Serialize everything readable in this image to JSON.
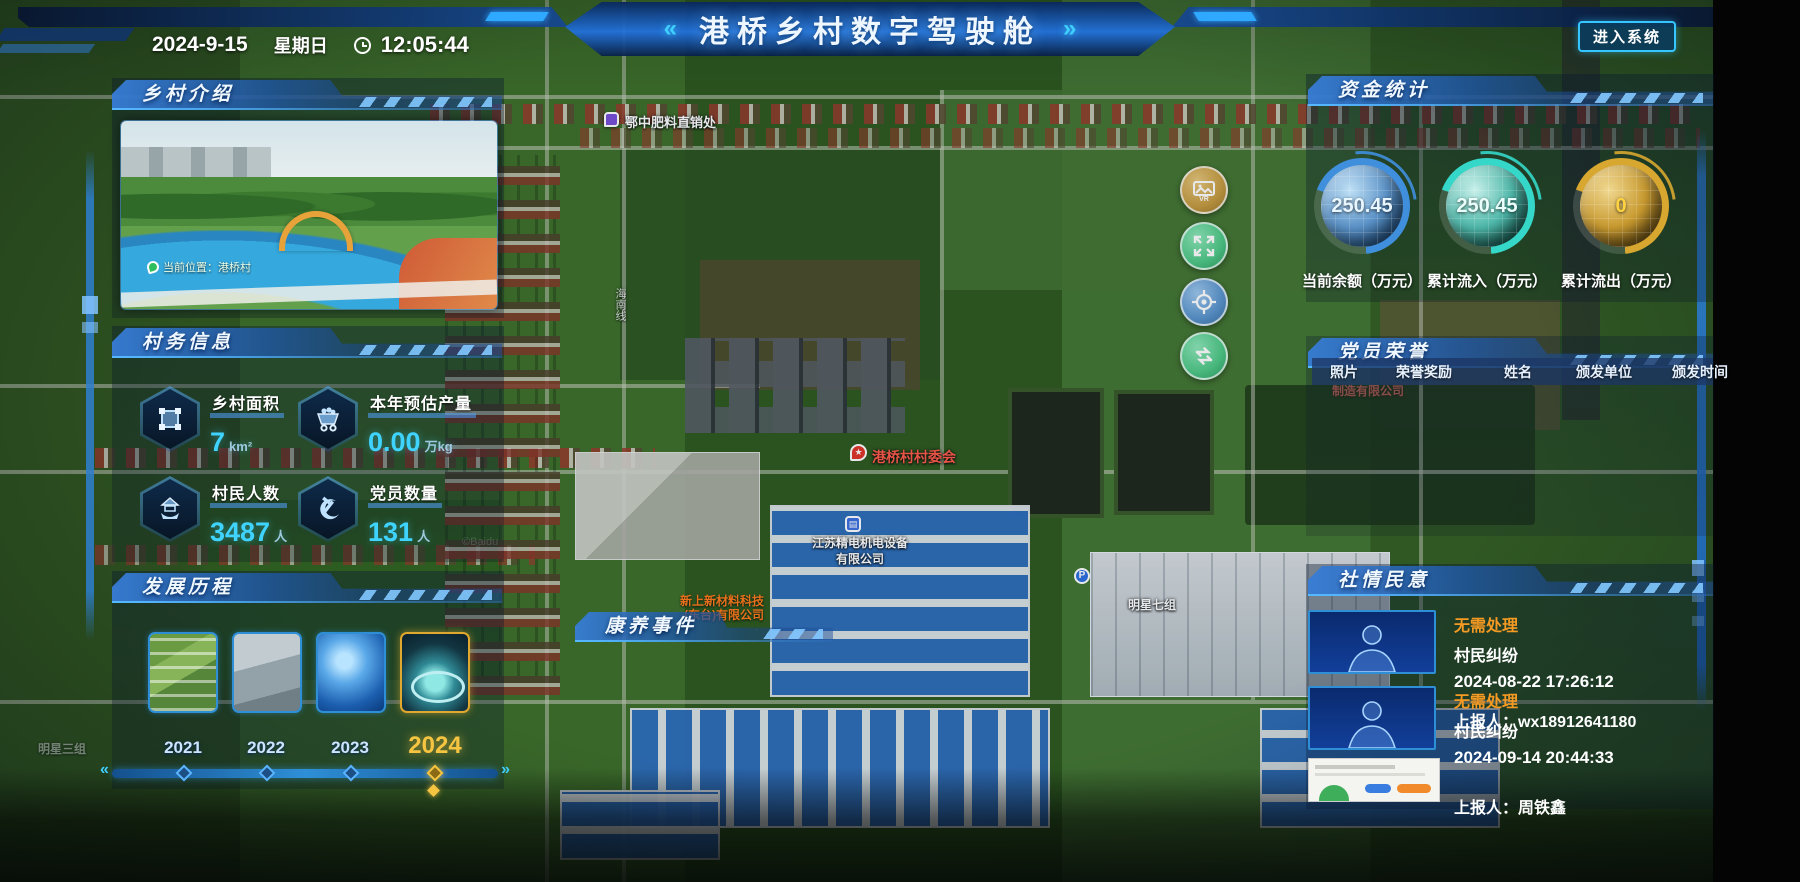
{
  "header": {
    "date": "2024-9-15",
    "weekday": "星期日",
    "time": "12:05:44",
    "title": "港桥乡村数字驾驶舱",
    "chevrons_left": "«",
    "chevrons_right": "»",
    "enter_button": "进入系统"
  },
  "panels": {
    "intro": {
      "title": "乡村介绍",
      "photo_badge": "当前位置：港桥村"
    },
    "info": {
      "title": "村务信息",
      "stats": [
        {
          "label": "乡村面积",
          "value": "7",
          "unit": "km²"
        },
        {
          "label": "本年预估产量",
          "value": "0.00",
          "unit": "万kg"
        },
        {
          "label": "村民人数",
          "value": "3487",
          "unit": "人"
        },
        {
          "label": "党员数量",
          "value": "131",
          "unit": "人"
        }
      ]
    },
    "development": {
      "title": "发展历程",
      "years": [
        "2021",
        "2022",
        "2023",
        "2024"
      ],
      "active_year": "2024",
      "prev_arrow": "«",
      "next_arrow": "»"
    },
    "funds": {
      "title": "资金统计",
      "gauges": [
        {
          "value": "250.45",
          "label": "当前余额（万元）",
          "color": "#3f8fdd"
        },
        {
          "value": "250.45",
          "label": "累计流入（万元）",
          "color": "#35d8c8"
        },
        {
          "value": "0",
          "label": "累计流出（万元）",
          "color": "#d8a72f"
        }
      ]
    },
    "honors": {
      "title": "党员荣誉",
      "columns": [
        "照片",
        "荣誉奖励",
        "姓名",
        "颁发单位",
        "颁发时间"
      ]
    },
    "opinion": {
      "title": "社情民意",
      "items": [
        {
          "status": "无需处理",
          "category": "村民纠纷",
          "time": "2024-08-22 17:26:12",
          "reporter": "上报人：wx18912641180"
        },
        {
          "status": "无需处理",
          "category": "村民纠纷",
          "time": "2024-09-14 20:44:33",
          "reporter": "上报人：周铁鑫"
        }
      ]
    },
    "health": {
      "title": "康养事件"
    }
  },
  "map": {
    "pois": {
      "fertilizer": "鄂中肥料直销处",
      "committee": "港桥村村委会",
      "company1_line1": "江苏精电机电设备",
      "company1_line2": "有限公司",
      "company2_line1": "新上新材料科技",
      "company2_line2": "(东台)有限公司",
      "company3": "制造有限公司",
      "group7": "明星七组",
      "group3": "明星三组",
      "road": "海南线",
      "parking": "P",
      "watermark": "©Baidu"
    }
  }
}
